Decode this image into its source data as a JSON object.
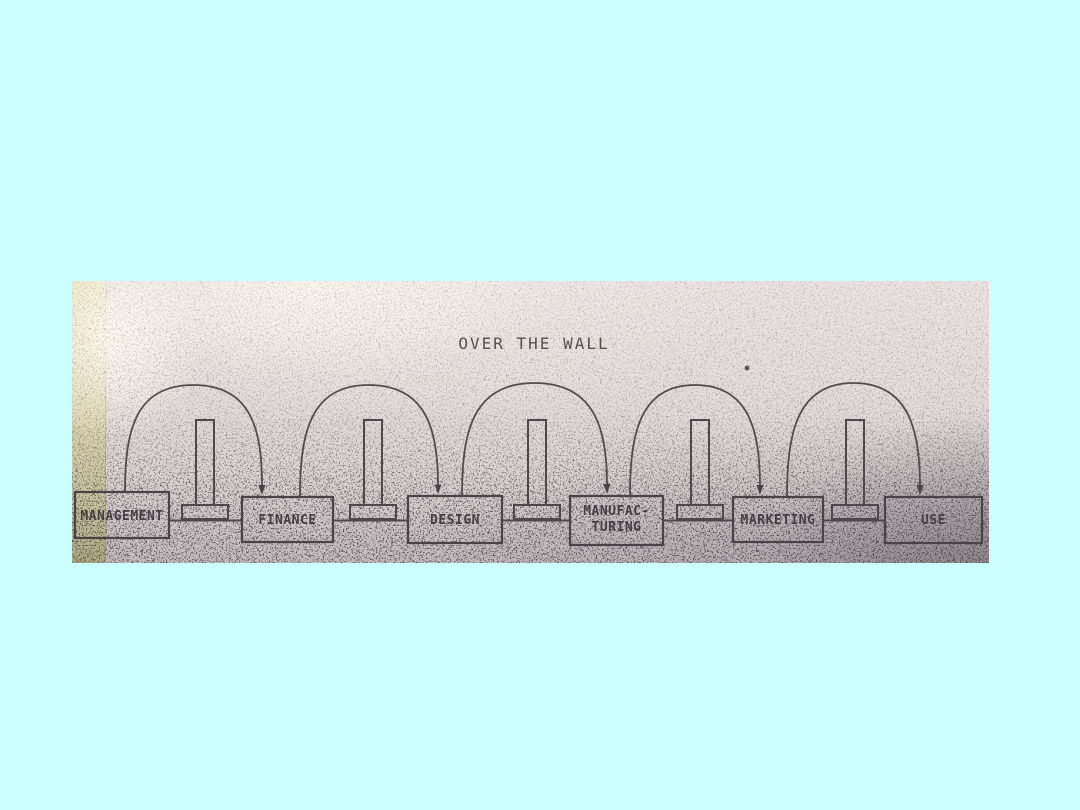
{
  "slide": {
    "background_color": "#ccffff"
  },
  "photo": {
    "title": "OVER THE WALL",
    "paper_color": "#e3dada",
    "ink_color": "#4a4247",
    "tape_color": "#ded6ac",
    "boxes": [
      {
        "label": "MANAGEMENT"
      },
      {
        "label": "FINANCE"
      },
      {
        "label": "DESIGN"
      },
      {
        "label": "MANUFAC-",
        "label2": "TURING"
      },
      {
        "label": "MARKETING"
      },
      {
        "label": "USE"
      }
    ],
    "connections": [
      {
        "from": "MANAGEMENT",
        "to": "FINANCE"
      },
      {
        "from": "FINANCE",
        "to": "DESIGN"
      },
      {
        "from": "DESIGN",
        "to": "MANUFACTURING"
      },
      {
        "from": "MANUFACTURING",
        "to": "MARKETING"
      },
      {
        "from": "MARKETING",
        "to": "USE"
      }
    ],
    "walls": [
      {
        "icon": "brick-wall-icon"
      },
      {
        "icon": "brick-wall-icon"
      },
      {
        "icon": "brick-wall-icon"
      },
      {
        "icon": "brick-wall-icon"
      },
      {
        "icon": "brick-wall-icon"
      }
    ]
  }
}
